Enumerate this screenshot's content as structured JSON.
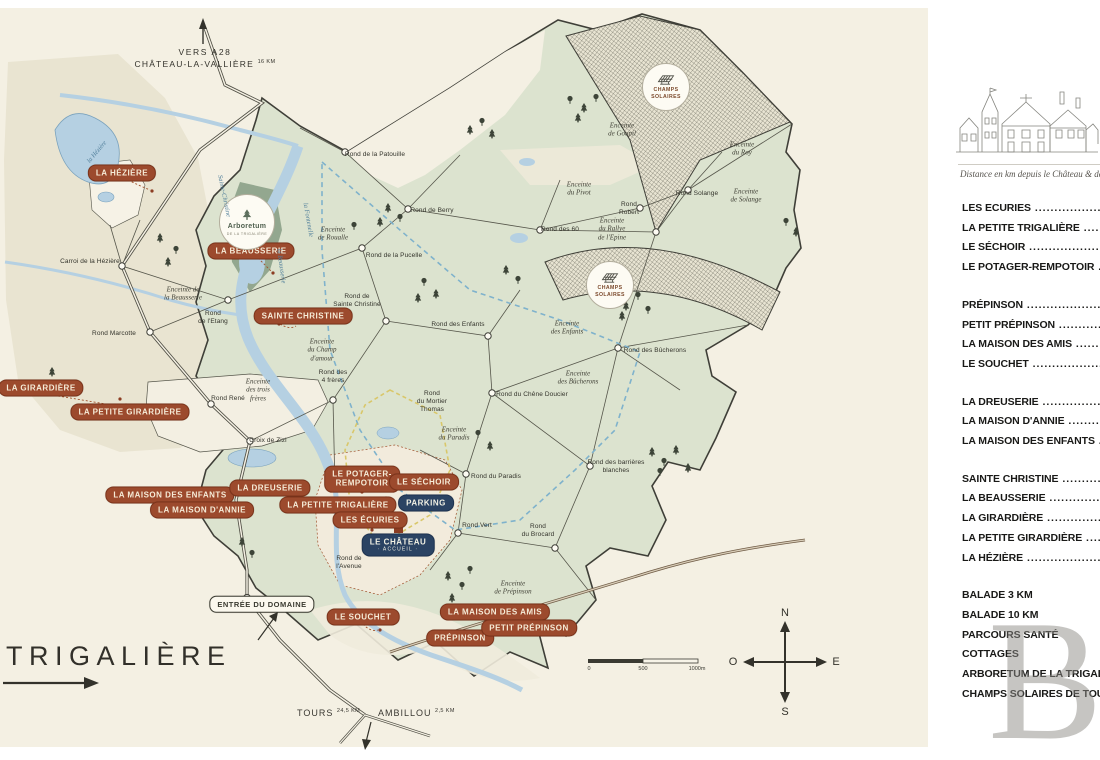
{
  "map": {
    "top_route": {
      "line1": "VERS A28",
      "line2": "CHÂTEAU-LA-VALLIÈRE",
      "distance": "16 KM"
    },
    "big_label": "TRIGALIÈRE",
    "bottom_routes": [
      {
        "name": "TOURS",
        "distance": "24,5 KM"
      },
      {
        "name": "AMBILLOU",
        "distance": "2,5 KM"
      }
    ],
    "scale": {
      "start": "0",
      "mid": "500",
      "end": "1000m"
    },
    "compass": {
      "n": "N",
      "s": "S",
      "e": "E",
      "o": "O"
    },
    "badges": [
      {
        "label": "LA HÉZIÈRE",
        "x": 122,
        "y": 173,
        "type": "red"
      },
      {
        "label": "LA BEAUSSERIE",
        "x": 251,
        "y": 251,
        "type": "red"
      },
      {
        "label": "SAINTE CHRISTINE",
        "x": 303,
        "y": 316,
        "type": "red"
      },
      {
        "label": "LA GIRARDIÈRE",
        "x": 41,
        "y": 388,
        "type": "red"
      },
      {
        "label": "LA PETITE GIRARDIÈRE",
        "x": 130,
        "y": 412,
        "type": "red"
      },
      {
        "label": "LA MAISON DES ENFANTS",
        "x": 170,
        "y": 495,
        "type": "red"
      },
      {
        "label": "LA DREUSERIE",
        "x": 270,
        "y": 488,
        "type": "red"
      },
      {
        "label": "LA MAISON D'ANNIE",
        "x": 202,
        "y": 510,
        "type": "red"
      },
      {
        "label": "LA PETITE TRIGALIÈRE",
        "x": 338,
        "y": 505,
        "type": "red"
      },
      {
        "label": "LE POTAGER-\nREMPOTOIR",
        "x": 362,
        "y": 479,
        "type": "red"
      },
      {
        "label": "LE SÉCHOIR",
        "x": 424,
        "y": 482,
        "type": "red"
      },
      {
        "label": "LES ÉCURIES",
        "x": 370,
        "y": 520,
        "type": "red"
      },
      {
        "label": "PARKING",
        "x": 426,
        "y": 503,
        "type": "navy"
      },
      {
        "label": "LE CHÂTEAU",
        "sub": "· ACCUEIL ·",
        "x": 398,
        "y": 545,
        "type": "navy"
      },
      {
        "label": "ENTRÉE DU DOMAINE",
        "x": 262,
        "y": 604,
        "type": "white"
      },
      {
        "label": "LE SOUCHET",
        "x": 363,
        "y": 617,
        "type": "red"
      },
      {
        "label": "LA MAISON DES AMIS",
        "x": 495,
        "y": 612,
        "type": "red"
      },
      {
        "label": "PRÉPINSON",
        "x": 460,
        "y": 638,
        "type": "red"
      },
      {
        "label": "PETIT PRÉPINSON",
        "x": 529,
        "y": 628,
        "type": "red"
      }
    ],
    "circle_badges": [
      {
        "label": "Arboretum",
        "sub": "DE LA TRIGALIÈRE",
        "x": 247,
        "y": 222,
        "r": 27,
        "icon": "tree"
      },
      {
        "label": "CHAMPS\nSOLAIRES",
        "x": 666,
        "y": 87,
        "r": 23,
        "icon": "solar"
      },
      {
        "label": "CHAMPS\nSOLAIRES",
        "x": 610,
        "y": 285,
        "r": 23,
        "icon": "solar"
      }
    ],
    "place_labels": [
      {
        "text": "Rond de la Patouille",
        "x": 375,
        "y": 155
      },
      {
        "text": "Rond de Berry",
        "x": 432,
        "y": 211
      },
      {
        "text": "Rond de la Pucelle",
        "x": 394,
        "y": 256
      },
      {
        "text": "Rond de\nSainte Christine",
        "x": 357,
        "y": 301
      },
      {
        "text": "Rond\nde l'Etang",
        "x": 213,
        "y": 318
      },
      {
        "text": "Rond Marcotte",
        "x": 114,
        "y": 334
      },
      {
        "text": "Carroi de la Hézière",
        "x": 90,
        "y": 262
      },
      {
        "text": "Rond René",
        "x": 228,
        "y": 399
      },
      {
        "text": "Croix de Zizi",
        "x": 268,
        "y": 441
      },
      {
        "text": "Rond des\n4 frères",
        "x": 333,
        "y": 377
      },
      {
        "text": "Rond des Enfants",
        "x": 458,
        "y": 325
      },
      {
        "text": "Rond des Bûcherons",
        "x": 655,
        "y": 351
      },
      {
        "text": "Rond du Chêne Doucier",
        "x": 532,
        "y": 395
      },
      {
        "text": "Rond\ndu Mortier\nThomas",
        "x": 432,
        "y": 402
      },
      {
        "text": "Rond du Paradis",
        "x": 496,
        "y": 477
      },
      {
        "text": "Rond des barrières\nblanches",
        "x": 616,
        "y": 467
      },
      {
        "text": "Rond Vert",
        "x": 477,
        "y": 526
      },
      {
        "text": "Rond\ndu Brocard",
        "x": 538,
        "y": 531
      },
      {
        "text": "Rond de\nl'Avenue",
        "x": 349,
        "y": 563
      },
      {
        "text": "Rond Solange",
        "x": 697,
        "y": 194
      },
      {
        "text": "Rond\nRobert",
        "x": 629,
        "y": 209
      },
      {
        "text": "Rond des 60",
        "x": 560,
        "y": 230
      }
    ],
    "area_labels": [
      {
        "text": "Enceinte\nde Roualle",
        "x": 333,
        "y": 234
      },
      {
        "text": "Enceinte de\nla Beausserie",
        "x": 183,
        "y": 294
      },
      {
        "text": "Enceinte\ndu Champ\nd'amour",
        "x": 322,
        "y": 350
      },
      {
        "text": "Enceinte\ndes trois\nfrères",
        "x": 258,
        "y": 390
      },
      {
        "text": "Enceinte\nde Goupil",
        "x": 622,
        "y": 130
      },
      {
        "text": "Enceinte\ndu Roy",
        "x": 742,
        "y": 149
      },
      {
        "text": "Enceinte\ndu Pivot",
        "x": 579,
        "y": 189
      },
      {
        "text": "Enceinte\nde Solange",
        "x": 746,
        "y": 196
      },
      {
        "text": "Enceinte\ndu Rallye\nde l'Epine",
        "x": 612,
        "y": 229
      },
      {
        "text": "Enceinte\ndes Enfants",
        "x": 567,
        "y": 328
      },
      {
        "text": "Enceinte\ndes Bûcherons",
        "x": 578,
        "y": 378
      },
      {
        "text": "Enceinte\ndu Paradis",
        "x": 454,
        "y": 434
      },
      {
        "text": "Enceinte\nde Prépinson",
        "x": 513,
        "y": 588
      }
    ],
    "river_labels": [
      {
        "text": "la Hézière",
        "x": 97,
        "y": 152,
        "rot": -50
      },
      {
        "text": "Sainte-Christine",
        "x": 224,
        "y": 196,
        "rot": 78
      },
      {
        "text": "la Beausserie",
        "x": 281,
        "y": 266,
        "rot": 82
      },
      {
        "text": "la Fontenelle",
        "x": 308,
        "y": 220,
        "rot": 80
      }
    ]
  },
  "sidebar": {
    "caption": "Distance en km depuis le Château & des",
    "groups": [
      {
        "leaders": true,
        "items": [
          "LES ECURIES",
          "LA PETITE TRIGALIÈRE",
          "LE SÉCHOIR",
          "LE POTAGER-REMPOTOIR"
        ]
      },
      {
        "leaders": true,
        "items": [
          "PRÉPINSON",
          "PETIT PRÉPINSON",
          "LA MAISON DES AMIS",
          "LE SOUCHET"
        ]
      },
      {
        "leaders": true,
        "items": [
          "LA DREUSERIE",
          "LA MAISON D'ANNIE",
          "LA MAISON DES ENFANTS"
        ]
      },
      {
        "leaders": true,
        "items": [
          "SAINTE CHRISTINE",
          "LA BEAUSSERIE",
          "LA GIRARDIÈRE",
          "LA PETITE GIRARDIÈRE",
          "LA HÉZIÈRE"
        ]
      },
      {
        "leaders": false,
        "items": [
          "BALADE 3 KM",
          "BALADE 10 KM",
          "PARCOURS SANTÉ",
          "COTTAGES",
          "ARBORETUM DE LA TRIGALIÈRE",
          "CHAMPS SOLAIRES DE TOURAINE"
        ]
      }
    ],
    "watermark": "B"
  },
  "colors": {
    "map_background": "#f4f0e3",
    "estate_green": "#dce3cf",
    "badge_red": "#9c4a2d",
    "badge_navy": "#2b4363",
    "water_blue": "#b5d0e2"
  }
}
